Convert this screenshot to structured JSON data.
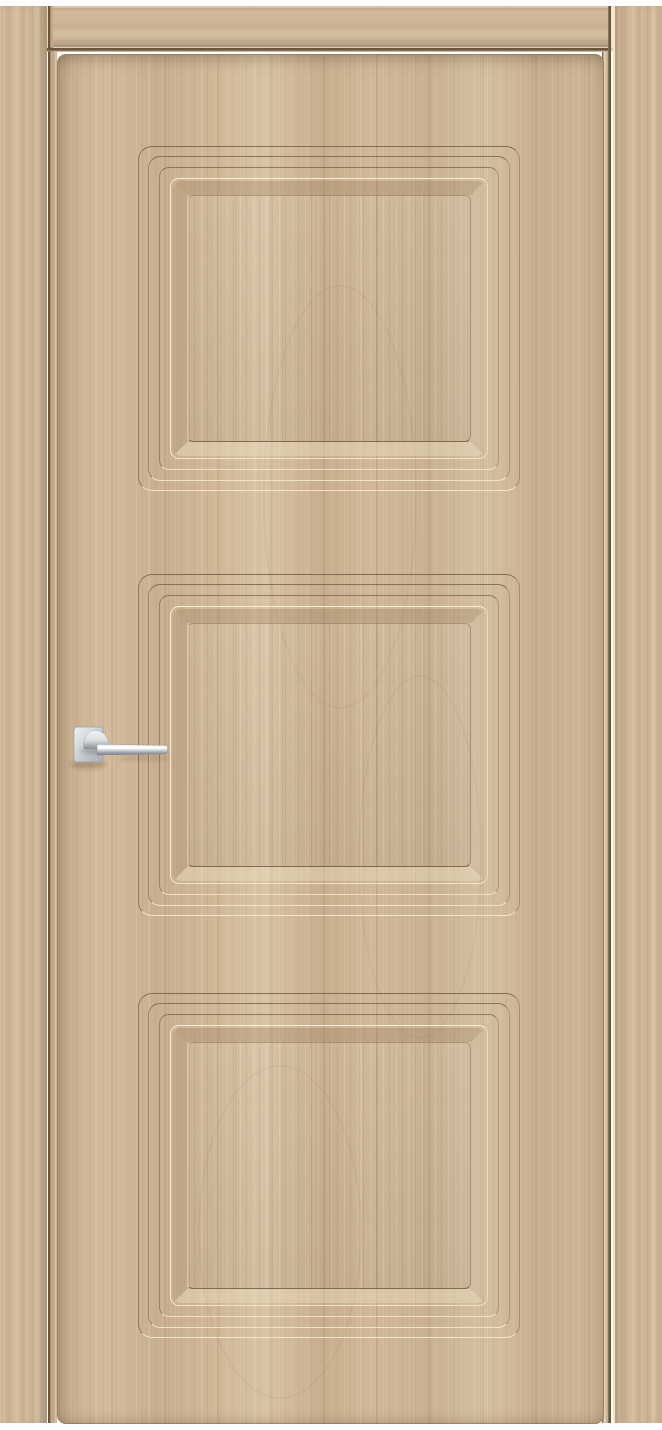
{
  "meta": {
    "content_type": "product photograph",
    "subject": "closed interior door with casing, front view"
  },
  "scene": {
    "door_leaf": {
      "style": "door leaf with three recessed rectangular panels framed by triple stepped groove moldings and a raised inner field",
      "finish": "light oak woodgrain laminate, vertical grain",
      "panel_count": 3
    },
    "door_frame": {
      "type": "flat architrave casing in matching light oak, butt-jointed at top corners"
    },
    "handle": {
      "type": "straight lever handle on a square rosette, lever pointing right",
      "finish": "satin chrome"
    }
  },
  "colors": {
    "bg": "#ffffff",
    "wood_base": "#cbb294",
    "wood_light": "#dcc9ac",
    "wood_dark": "#b2987a",
    "grain_dark": "#9c8166",
    "seam_dark": "#6b563d",
    "groove_dark": "#8a7153",
    "groove_light": "#f0e2c4",
    "bevel_shadow": "#ad9071",
    "bevel_light": "#e3d2b2",
    "edge_light": "#e5d4b6",
    "chrome_light": "#f5f7f8",
    "chrome_mid": "#d5d9dc",
    "chrome_dark": "#8f959b",
    "handle_shadow": "rgba(92,70,48,0.32)"
  }
}
